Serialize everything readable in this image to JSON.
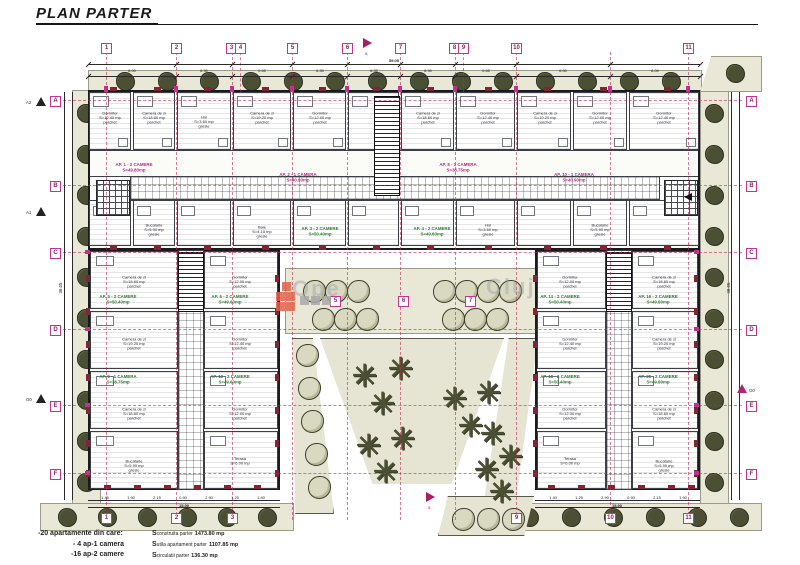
{
  "title": "PLAN PARTER",
  "watermark": {
    "left": "Ope",
    "right": "Cluj"
  },
  "grid": {
    "top": [
      "1",
      "2",
      "3",
      "4",
      "5",
      "6",
      "7",
      "8",
      "9",
      "10",
      "11"
    ],
    "bottom_left": [
      "1",
      "2",
      "3"
    ],
    "bottom_right": [
      "9",
      "10",
      "11"
    ],
    "left_rows": [
      "A",
      "B",
      "C",
      "D",
      "E",
      "F"
    ],
    "right_rows": [
      "A",
      "B",
      "C",
      "D",
      "E",
      "F"
    ],
    "courtyard_axes": [
      "5",
      "6",
      "7"
    ],
    "section_markers_left": [
      "A2",
      "A1",
      "G0"
    ],
    "section_marker_right": "G0",
    "flag_label": "a"
  },
  "dimensions": {
    "top_total": "59.05",
    "top_segments": [
      "8.00",
      "6.30",
      "0.65",
      "6.30",
      "8.35",
      "6.30",
      "0.65",
      "6.30",
      "8.00"
    ],
    "bottom_left_total": "15.90",
    "bottom_right_total": "15.90",
    "bottom_left_segments": [
      "1.45",
      "1.90",
      "2.15",
      "0.90",
      "2.90",
      "1.25",
      "1.40"
    ],
    "bottom_right_segments": [
      "1.40",
      "1.25",
      "2.90",
      "0.90",
      "2.15",
      "1.90"
    ],
    "left_total": "38.05",
    "right_total": "38.05"
  },
  "apartments": {
    "magenta": [
      "AP. 1 - 2 CAMERE\nS=49.80mp",
      "AP. 2 - 1 CAMERA\nS=40.90mp",
      "AP. 8 - 1 CAMERA\nS=38.75mp",
      "AP. 10 - 1 CAMERA\nS=40.90mp"
    ],
    "green": [
      "AP. 3 - 2 CAMERE\nS=50.40mp",
      "AP. 4 - 2 CAMERE\nS=49.60mp",
      "AP. 5 - 2 CAMERE\nS=50.40mp",
      "AP. 6 - 2 CAMERE\nS=49.60mp",
      "AP. 9 - 1 CAMERA\nS=38.75mp",
      "AP. 12 - 2 CAMERE\nS=49.60mp",
      "AP. 14 - 2 CAMERE\nS=50.40mp",
      "AP. 16 - 2 CAMERE\nS=49.60mp",
      "AP. 18 - 2 CAMERE\nS=50.40mp",
      "AP. 20 - 2 CAMERE\nS=49.60mp"
    ]
  },
  "room_labels": [
    "Dormitor\nS=12.40 mp\nparchet",
    "Camera de zi\nS=18.60 mp\nparchet",
    "Bucatarie\nS=5.90 mp\ngresie",
    "Baie\nS=4.10 mp\ngresie",
    "Hol\nS=3.60 mp\ngresie",
    "Dormitor\nS=12.00 mp\nparchet",
    "Camera de zi\nS=19.20 mp\nparchet",
    "Terasa\nS=6.00 mp"
  ],
  "legend": {
    "line1": "-20 apartamente din care:",
    "line2": "- 4 ap-1 camera",
    "line3": "-16 ap-2 camere",
    "areas": [
      {
        "prefix": "S",
        "label": "construita parter",
        "value": "1473.80 mp"
      },
      {
        "prefix": "S",
        "label": "utila apartament parter",
        "value": "1107.85 mp"
      },
      {
        "prefix": "S",
        "label": "circulatii parter",
        "value": "136.30 mp"
      }
    ]
  },
  "colors": {
    "magenta": "#c0368f",
    "grid_red": "#c42a55",
    "green_label": "#2e7d32",
    "landscape": "#e9e7d6",
    "tree": "#4b4f33",
    "logo_orange": "#e2604a",
    "logo_gray": "#a9a9a9"
  }
}
